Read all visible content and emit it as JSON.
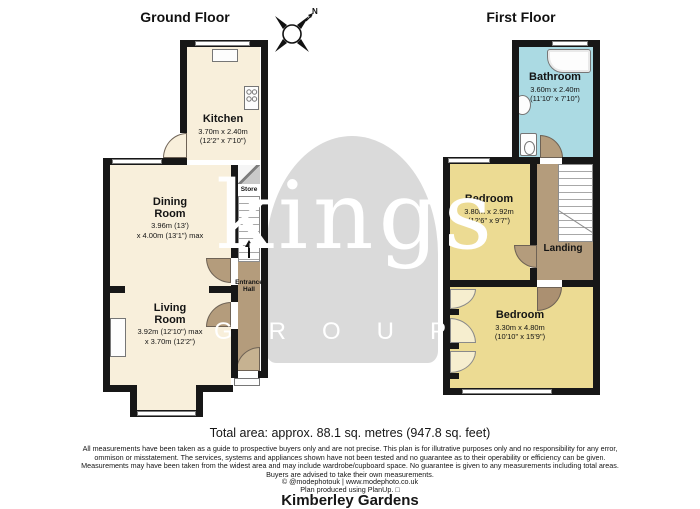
{
  "header": {
    "ground_floor": "Ground Floor",
    "first_floor": "First Floor",
    "compass_n": "N"
  },
  "ground_floor": {
    "kitchen": {
      "name": "Kitchen",
      "dims1": "3.70m x 2.40m",
      "dims2": "(12'2\" x 7'10\")"
    },
    "dining_room": {
      "name": "Dining Room",
      "dims1": "3.96m (13')",
      "dims2": "x 4.00m (13'1\") max"
    },
    "living_room": {
      "name": "Living Room",
      "dims1": "3.92m (12'10\") max",
      "dims2": "x 3.70m (12'2\")"
    },
    "store": {
      "name": "Store"
    },
    "entrance_hall": {
      "name": "Entrance Hall"
    }
  },
  "first_floor": {
    "bathroom": {
      "name": "Bathroom",
      "dims1": "3.60m x 2.40m",
      "dims2": "(11'10\" x 7'10\")"
    },
    "bedroom_front": {
      "name": "Bedroom",
      "dims1": "3.80m x 2.92m",
      "dims2": "(12'6\" x 9'7\")"
    },
    "bedroom_back": {
      "name": "Bedroom",
      "dims1": "3.30m x 4.80m",
      "dims2": "(10'10\" x 15'9\")"
    },
    "landing": {
      "name": "Landing"
    }
  },
  "watermark": {
    "word": "kings",
    "group": "GROUP"
  },
  "footer": {
    "total_area": "Total area: approx. 88.1 sq. metres (947.8 sq. feet)",
    "disclaimer_lines": [
      "All measurements have been taken as a guide to prospective buyers only and are not precise. This plan is for illutrative purposes only and no responsibility for any error,",
      "ommison or misstatement. The services, systems and appliances shown have not been tested and no guarantee as to their operability or efficiency can be given.",
      "Measurements may have been taken from the widest area and may include wardrobe/cupboard space. No guarantee is given to any measurements including total areas.",
      "Buyers are advised to take their own measurements."
    ],
    "credit1": "© @modephotouk | www.modephoto.co.uk",
    "credit2": "Plan produced using PlanUp. □",
    "property_name": "Kimberley Gardens"
  },
  "colors": {
    "floor_cream": "#f8efdb",
    "bedroom_yellow": "#ecdb93",
    "bathroom_blue": "#abdae3",
    "hall_brown": "#b49c7c",
    "wall": "#171717",
    "watermark_gray": "#dadada"
  }
}
